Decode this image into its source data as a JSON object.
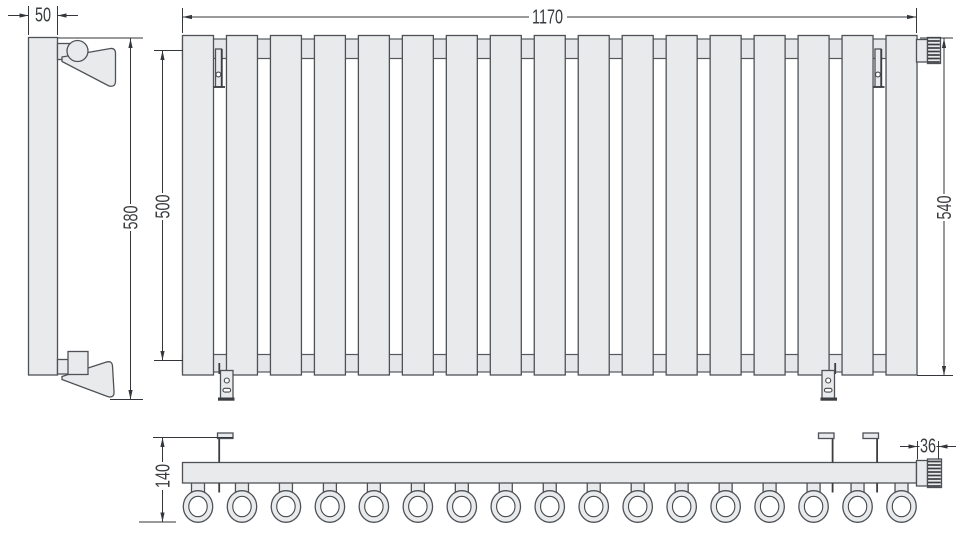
{
  "drawing": {
    "kind": "radiator-dimension-drawing",
    "sections_count": 17,
    "dimensions": {
      "side_depth": "50",
      "side_overall_height": "580",
      "overall_width": "1170",
      "mounting_height": "500",
      "height_with_valve": "540",
      "top_view_depth": "140",
      "valve_width": "36"
    },
    "colors": {
      "background": "#ffffff",
      "part_fill": "#e9eaeb",
      "part_outline": "#4e5257",
      "dimension_lines": "#33363a"
    }
  }
}
